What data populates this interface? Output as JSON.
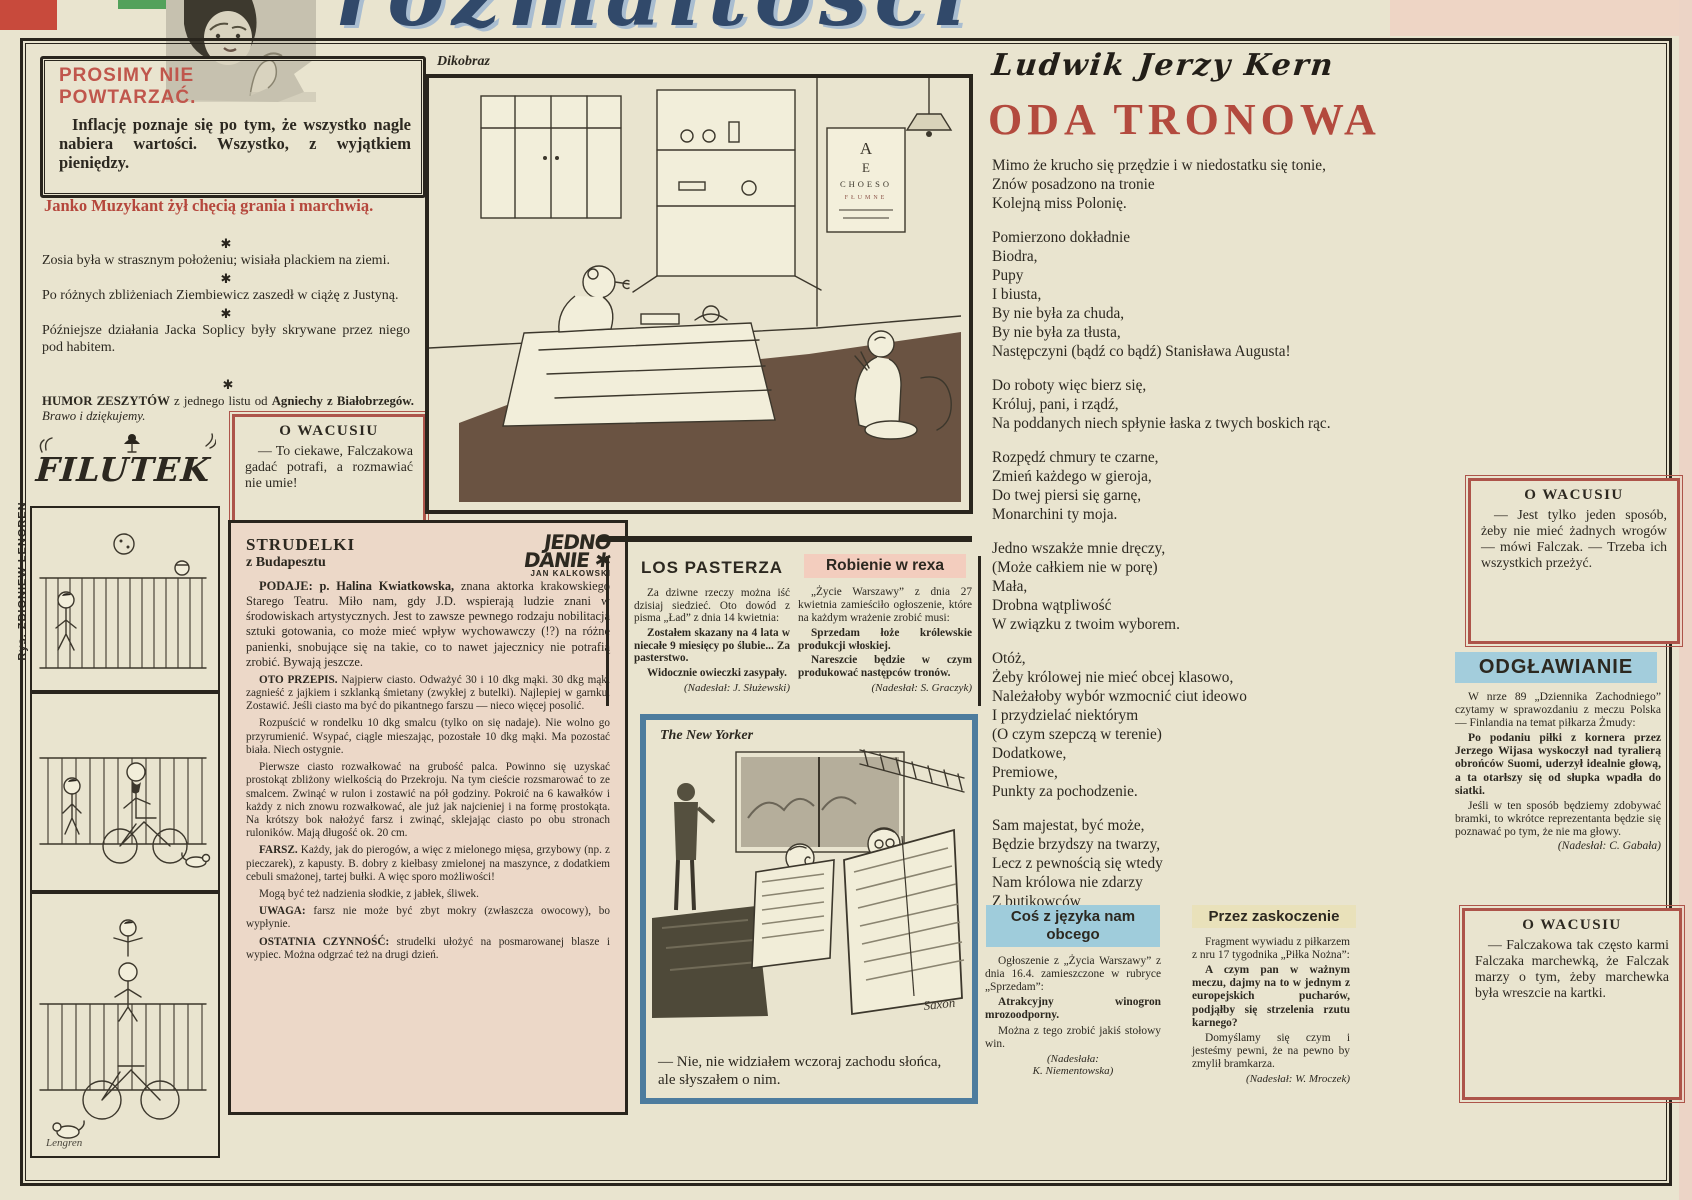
{
  "masthead": {
    "script_title": "rozmaitości"
  },
  "margin_credit": "Rys. ZBIGNIEW LENGREN",
  "colors": {
    "accent_red": "#b5473c",
    "box_red": "#ad544a",
    "ny_blue": "#4d7c9e",
    "pink_header": "#f3cdbe",
    "blue_header": "#a3cddc",
    "yellow_header": "#e9e1ba",
    "paper": "#e9e4cf",
    "strudelki_bg": "#ecd8c8"
  },
  "prosimy": {
    "title1": "PROSIMY NIE",
    "title2": "POWTARZAĆ.",
    "body": "Inflację poznaje się po tym, że wszystko nagle nabiera wartości. Wszystko, z wyjątkiem pieniędzy."
  },
  "janko": "Janko Muzykant żył chęcią grania i marchwią.",
  "jokes": [
    "Zosia była w strasznym położeniu; wisiała plackiem na ziemi.",
    "Po różnych zbliżeniach Ziembiewicz zaszedł w ciążę z Justyną.",
    "Późniejsze działania Jacka Soplicy były skrywane przez niego pod habitem."
  ],
  "humor": {
    "lead": "HUMOR ZESZYTÓW",
    "mid": " z jednego listu od ",
    "names": "Agniechy z Białobrzegów. ",
    "tail": "Brawo i dziękujemy."
  },
  "wacusiu1": {
    "title": "O WACUSIU",
    "text": "— To ciekawe, Falczakowa gadać potrafi, a rozmawiać nie umie!"
  },
  "filutek": {
    "title": "FILUTEK",
    "signature": "Lengren"
  },
  "dikobraz": {
    "label": "Dikobraz",
    "chart_rows": [
      "A",
      "E",
      "CHOESO",
      "FŁUMNE"
    ]
  },
  "strudelki": {
    "logo_line1": "JEDNO",
    "logo_line2": "DANIE ✱",
    "logo_byline": "JAN KALKOWSKI",
    "title": "STRUDELKI",
    "subtitle": "z Budapesztu",
    "paras": [
      {
        "cls": "first",
        "lead": "PODAJE: p. Halina Kwiatkowska,",
        "text": "znana aktorka krakowskiego Starego Teatru. Miło nam, gdy J.D. wspierają ludzie znani w środowiskach artystycznych. Jest to zawsze pewnego rodzaju nobilitacja sztuki gotowania, co może mieć wpływ wychowawczy (!?) na różne panienki, snobujące się na takie, co to nawet jajecznicy nie potrafią zrobić. Bywają jeszcze."
      },
      {
        "lead": "OTO PRZEPIS.",
        "text": "Najpierw ciasto. Odważyć 30 i 10 dkg mąki. 30 dkg mąki zagnieść z jajkiem i szklanką śmietany (zwykłej z butelki). Najlepiej w garnku. Zostawić. Jeśli ciasto ma być do pikantnego farszu — nieco więcej posolić."
      },
      {
        "text": "Rozpuścić w rondelku 10 dkg smalcu (tylko on się nadaje). Nie wolno go przyrumienić. Wsypać, ciągle mieszając, pozostałe 10 dkg mąki. Ma pozostać biała. Niech ostygnie."
      },
      {
        "text": "Pierwsze ciasto rozwałkować na grubość palca. Powinno się uzyskać prostokąt zbliżony wielkością do Przekroju. Na tym cieście rozsmarować to ze smalcem. Zwinąć w rulon i zostawić na pół godziny. Pokroić na 6 kawałków i każdy z nich znowu rozwałkować, ale już jak najcieniej i na formę prostokąta. Na krótszy bok nałożyć farsz i zwinąć, sklejając ciasto po obu stronach ruloników. Mają długość ok. 20 cm."
      },
      {
        "lead": "FARSZ.",
        "text": "Każdy, jak do pierogów, a więc z mielonego mięsa, grzybowy (np. z pieczarek), z kapusty. B. dobry z kiełbasy zmielonej na maszynce, z dodatkiem cebuli smażonej, tartej bułki. A więc sporo możliwości!"
      },
      {
        "text": "Mogą być też nadzienia słodkie, z jabłek, śliwek."
      },
      {
        "lead": "UWAGA:",
        "text": "farsz nie może być zbyt mokry (zwłaszcza owocowy), bo wypłynie."
      },
      {
        "lead": "OSTATNIA CZYNNOŚĆ:",
        "text": "strudelki ułożyć na posmarowanej blasze i wypiec. Można odgrzać też na drugi dzień."
      }
    ]
  },
  "los_pasterza": {
    "title": "LOS PASTERZA",
    "paras": [
      {
        "text": "Za dziwne rzeczy można iść dzisiaj siedzieć. Oto dowód z pisma „Ład” z dnia 14 kwietnia:"
      },
      {
        "b": true,
        "text": "Zostałem skazany na 4 lata w niecałe 9 miesięcy po ślubie... Za pasterstwo."
      },
      {
        "b": true,
        "text": "Widocznie owieczki zasypały."
      }
    ],
    "credit": "(Nadesłał: J. Służewski)"
  },
  "robienie": {
    "title": "Robienie w rexa",
    "paras": [
      {
        "text": "„Życie Warszawy” z dnia 27 kwietnia zamieściło ogłoszenie, które na każdym wrażenie zrobić musi:"
      },
      {
        "b": true,
        "text": "Sprzedam łoże królewskie produkcji włoskiej."
      },
      {
        "b": true,
        "text": "Nareszcie będzie w czym produkować następców tronów."
      }
    ],
    "credit": "(Nadesłał: S. Graczyk)"
  },
  "new_yorker": {
    "label": "The New Yorker",
    "caption": "— Nie, nie widziałem wczoraj zachodu słońca, ale słyszałem o nim.",
    "signature": "Saxon"
  },
  "poem": {
    "author": "Ludwik Jerzy Kern",
    "title": "ODA TRONOWA",
    "stanzas": [
      [
        "Mimo że krucho się przędzie i w niedostatku się tonie,",
        "Znów posadzono na tronie",
        "Kolejną miss Polonię."
      ],
      [
        "Pomierzono dokładnie",
        "Biodra,",
        "Pupy",
        "I biusta,",
        "By nie była za chuda,",
        "By nie była za tłusta,",
        "Następczyni (bądź co bądź) Stanisława Augusta!"
      ],
      [
        "Do roboty więc bierz się,",
        "Króluj, pani, i rządź,",
        "Na poddanych niech spłynie łaska z twych boskich rąc."
      ],
      [
        "Rozpędź chmury te czarne,",
        "Zmień każdego w gieroja,",
        "Do twej piersi się garnę,",
        "Monarchini ty moja."
      ],
      [
        "Jedno wszakże mnie dręczy,",
        "(Może całkiem nie w porę)",
        "Mała,",
        "Drobna wątpliwość",
        "W związku z twoim wyborem."
      ],
      [
        "Otóż,",
        "Żeby królowej nie mieć obcej klasowo,",
        "Należałoby wybór wzmocnić ciut ideowo",
        "I przydzielać niektórym",
        "(O czym szepczą w terenie)",
        "Dodatkowe,",
        "Premiowe,",
        "Punkty za pochodzenie."
      ],
      [
        "Sam majestat, być może,",
        "Będzie brzydszy na twarzy,",
        "Lecz z pewnością się wtedy",
        "Nam królowa nie zdarzy",
        "Z butikowców",
        "Lub badylarzy."
      ]
    ]
  },
  "wacusiu2": {
    "title": "O WACUSIU",
    "text": "— Jest tylko jeden sposób, żeby nie mieć żadnych wrogów — mówi Falczak. — Trzeba ich wszystkich przeżyć."
  },
  "odglawianie": {
    "title": "ODGŁAWIANIE",
    "paras": [
      {
        "text": "W nrze 89 „Dziennika Zachodniego” czytamy w sprawozdaniu z meczu Polska — Finlandia na temat piłkarza Żmudy:"
      },
      {
        "b": true,
        "text": "Po podaniu piłki z kornera przez Jerzego Wijasa wyskoczył nad tyralierą obrońców Suomi, uderzył idealnie głową, a ta otarłszy się od słupka wpadła do siatki."
      },
      {
        "text": "Jeśli w ten sposób będziemy zdobywać bramki, to wkrótce reprezentanta będzie się poznawać po tym, że nie ma głowy."
      }
    ],
    "credit": "(Nadesłał: C. Gabała)"
  },
  "cos_obcego": {
    "title1": "Coś z języka nam",
    "title2": "obcego",
    "paras": [
      {
        "text": "Ogłoszenie z „Życia Warszawy” z dnia 16.4. zamieszczone w rubryce „Sprzedam”:"
      },
      {
        "b": true,
        "text": "Atrakcyjny winogron mrozoodporny."
      },
      {
        "text": "Można z tego zrobić jakiś stołowy win."
      }
    ],
    "credit1": "(Nadesłała:",
    "credit2": "K. Niementowska)"
  },
  "przez_zaskoczenie": {
    "title": "Przez zaskoczenie",
    "paras": [
      {
        "text": "Fragment wywiadu z piłkarzem z nru 17 tygodnika „Piłka Nożna”:"
      },
      {
        "b": true,
        "text": "A czym pan w ważnym meczu, dajmy na to w jednym z europejskich pucharów, podjąłby się strzelenia rzutu karnego?"
      },
      {
        "text": "Domyślamy się czym i jesteśmy pewni, że na pewno by zmylił bramkarza."
      }
    ],
    "credit": "(Nadesłał: W. Mroczek)"
  },
  "wacusiu3": {
    "title": "O WACUSIU",
    "text": "— Falczakowa tak często karmi Falczaka marchewką, że Falczak marzy o tym, żeby marchewka była wreszcie na kartki."
  }
}
